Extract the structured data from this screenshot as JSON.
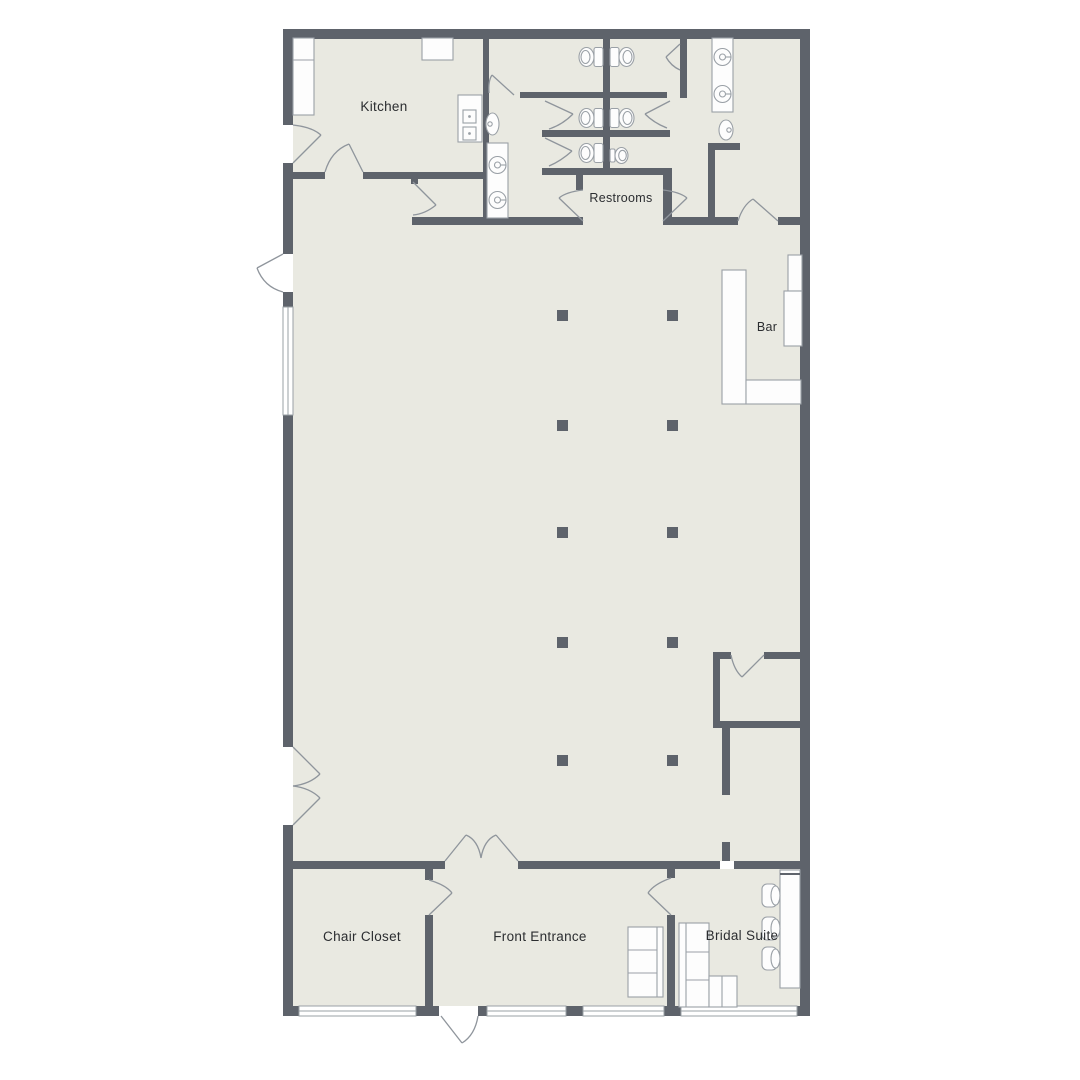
{
  "page": {
    "type": "floor-plan",
    "background": "#ffffff"
  },
  "palette": {
    "wall": "#5e636b",
    "floor": "#e9e9e1",
    "door_line": "#8f959c",
    "furniture_line": "#9aa0a6",
    "fixture_fill": "#fdfdfd",
    "text": "#2b2d30",
    "window_white": "#ffffff"
  },
  "rooms": [
    {
      "name": "kitchen",
      "label": "Kitchen"
    },
    {
      "name": "restrooms",
      "label": "Restrooms"
    },
    {
      "name": "bar",
      "label": "Bar"
    },
    {
      "name": "chair-closet",
      "label": "Chair Closet"
    },
    {
      "name": "front-entrance",
      "label": "Front Entrance"
    },
    {
      "name": "bridal-suite",
      "label": "Bridal Suite"
    }
  ],
  "fixtures": {
    "toilets": 5,
    "urinals": 1,
    "round_sinks": 4,
    "wall_sinks": 2,
    "columns": 10,
    "windows": 5,
    "icons": [
      "toilet-icon",
      "urinal-icon",
      "sink-icon",
      "stove-icon",
      "bar-counter-icon",
      "sofa-icon",
      "sectional-sofa-icon",
      "desk-icon",
      "chair-icon",
      "column-icon",
      "window-icon",
      "door-arc-icon"
    ]
  }
}
